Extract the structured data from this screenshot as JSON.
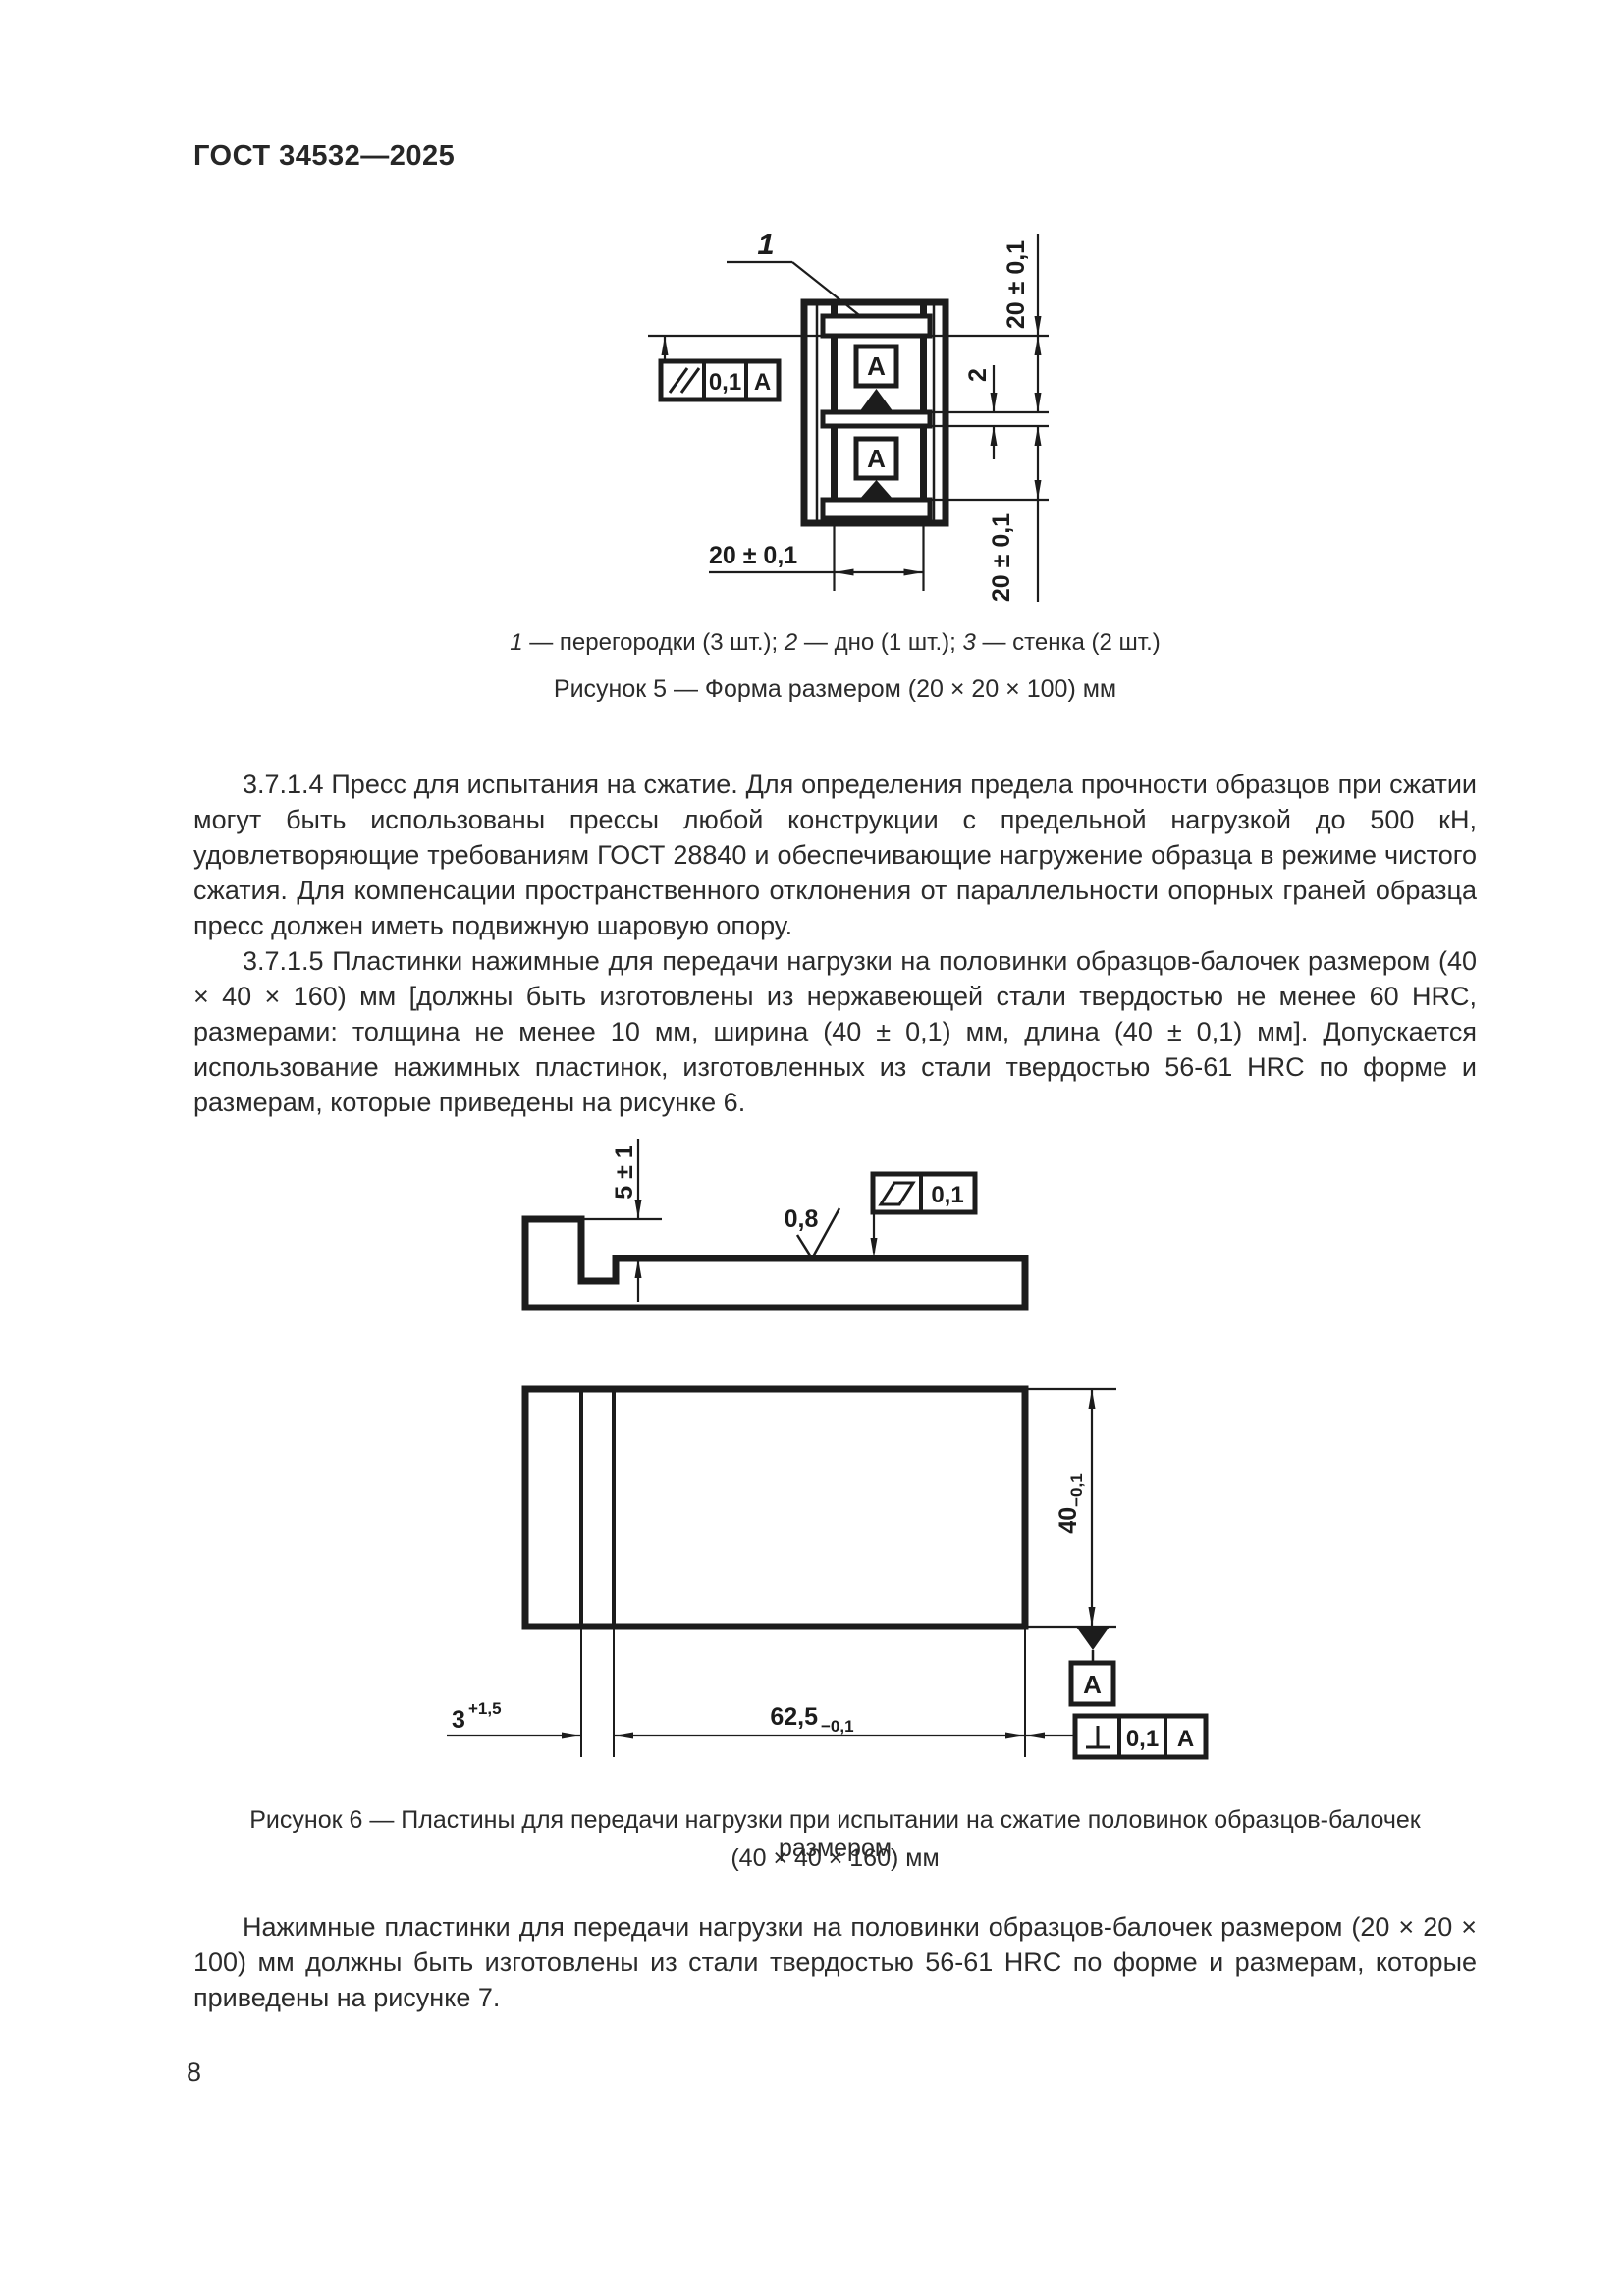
{
  "page": {
    "number": "8",
    "ink": "#1c1c1c"
  },
  "header": {
    "title": "ГОСТ 34532—2025"
  },
  "figure5": {
    "position_label": "1",
    "legend_segments": [
      {
        "text": "1",
        "italic": true
      },
      {
        "text": " — перегородки (3 шт.); ",
        "italic": false
      },
      {
        "text": "2",
        "italic": true
      },
      {
        "text": " — дно (1 шт.); ",
        "italic": false
      },
      {
        "text": "3",
        "italic": true
      },
      {
        "text": " — стенка (2 шт.)",
        "italic": false
      }
    ],
    "caption": "Рисунок 5 — Форма размером (20 × 20 × 100) мм",
    "parallelism_frame": {
      "tolerance": "0,1",
      "datum": "A"
    },
    "datum_box_top": "A",
    "datum_box_bottom": "A",
    "dims": {
      "cell_top": "20 ± 0,1",
      "partition_thickness": "2",
      "cell_bottom": "20 ± 0,1",
      "width_bottom": "20 ± 0,1"
    }
  },
  "paragraphs": {
    "p1": "3.7.1.4 Пресс для испытания на сжатие. Для определения предела прочности образцов при сжатии могут быть использованы прессы любой конструкции с предельной нагрузкой до 500 кН, удовлетворяющие требованиям ГОСТ 28840 и обеспечивающие нагружение образца в режиме чистого сжатия. Для компенсации пространственного отклонения от параллельности опорных граней образца пресс должен иметь подвижную шаровую опору.",
    "p2": "3.7.1.5 Пластинки нажимные для передачи нагрузки на половинки образцов-балочек размером (40 × 40 × 160) мм [должны быть изготовлены из нержавеющей стали твердостью не менее 60 HRC, размерами: толщина не менее 10 мм, ширина (40 ± 0,1) мм, длина (40 ± 0,1) мм]. Допускается использование нажимных пластинок, изготовленных из стали твердостью 56-61 HRC по форме и размерам, которые приведены на рисунке 6."
  },
  "figure6": {
    "caption_line1": "Рисунок 6 — Пластины для передачи нагрузки при испытании на сжатие половинок образцов-балочек размером",
    "caption_line2": "(40 × 40 × 160) мм",
    "dims": {
      "lip_height": "5 ± 1",
      "roughness": "0,8",
      "flatness_tolerance": "0,1",
      "thickness_main": "40",
      "thickness_tol": "−0,1",
      "step_main": "3",
      "step_tol": "+1,5",
      "length_main": "62,5",
      "length_tol": "−0,1"
    },
    "datum_box": "A",
    "perpendicularity_frame": {
      "tolerance": "0,1",
      "datum": "A"
    }
  },
  "paragraph_after": "Нажимные пластинки для передачи нагрузки на половинки образцов-балочек размером (20 × 20 × 100) мм должны быть изготовлены из стали твердостью 56-61 HRC по форме и размерам, которые приведены на рисунке 7."
}
